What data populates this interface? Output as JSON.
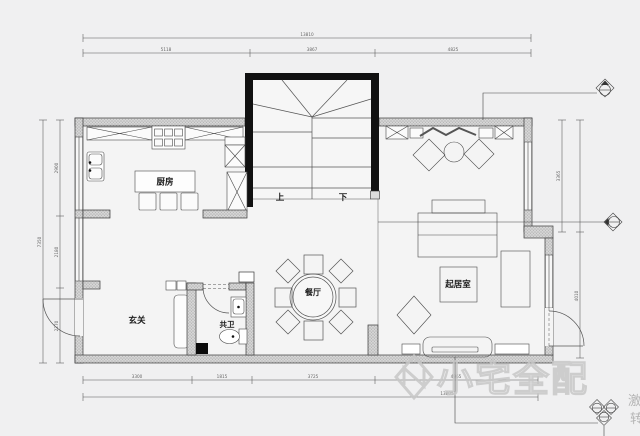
{
  "plan": {
    "rooms": {
      "kitchen": "厨房",
      "dining": "餐厅",
      "living": "起居室",
      "foyer": "玄关",
      "bathroom": "共卫"
    },
    "stairs": {
      "up": "上",
      "down": "下"
    }
  },
  "dimensions": {
    "top": {
      "overall": "13810",
      "segments": [
        "5118",
        "3867",
        "4825"
      ]
    },
    "left": {
      "overall": "7350",
      "segments": [
        "2900",
        "2180",
        "2270"
      ]
    },
    "right": {
      "upper": "3365",
      "lower": "4010"
    },
    "bottom": {
      "overall": "13805",
      "segments": [
        "3300",
        "1815",
        "3725",
        "4965"
      ]
    }
  },
  "watermark": {
    "brand": "小宅全配",
    "side_text_1": "激",
    "side_text_2": "转"
  },
  "colors": {
    "background": "#f0f0f1",
    "wall_fill": "#d4d4d4",
    "stair_wall": "#111111",
    "drawing_line": "#555555",
    "watermark": "#c7c7c7"
  }
}
